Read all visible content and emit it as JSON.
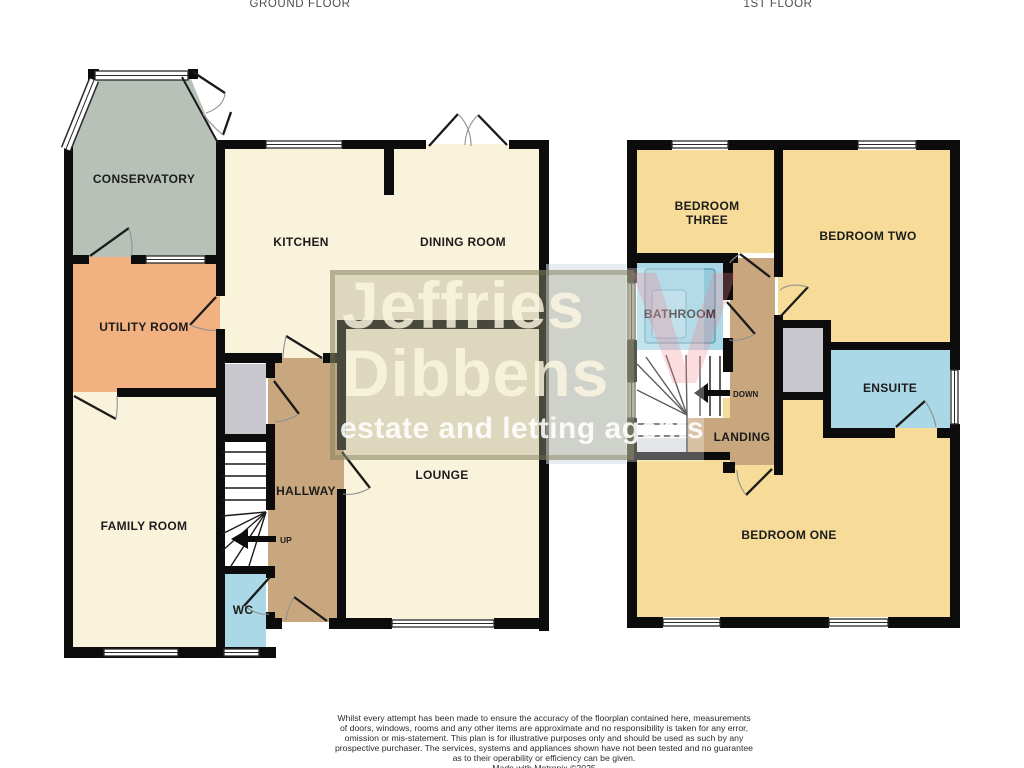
{
  "titles": {
    "ground": "GROUND FLOOR",
    "first": "1ST FLOOR"
  },
  "ground_floor": {
    "conservatory": "CONSERVATORY",
    "utility_room": "UTILITY ROOM",
    "family_room": "FAMILY ROOM",
    "kitchen": "KITCHEN",
    "dining_room": "DINING ROOM",
    "lounge": "LOUNGE",
    "hallway": "HALLWAY",
    "wc": "WC",
    "stairs_direction": "UP"
  },
  "first_floor": {
    "bedroom_three_line1": "BEDROOM",
    "bedroom_three_line2": "THREE",
    "bedroom_two": "BEDROOM TWO",
    "bathroom": "BATHROOM",
    "ensuite": "ENSUITE",
    "landing": "LANDING",
    "bedroom_one": "BEDROOM ONE",
    "stairs_direction": "DOWN"
  },
  "watermark": {
    "name_line1": "Jeffries",
    "name_line2": "Dibbens",
    "tagline": "estate and letting agents"
  },
  "disclaimer": {
    "lines": [
      "Whilst every attempt has been made to ensure the accuracy of the floorplan contained here, measurements",
      "of doors, windows, rooms and any other items are approximate and no responsibility is taken for any error,",
      "omission or mis-statement. This plan is for illustrative purposes only and should be used as such by any",
      "prospective purchaser. The services, systems and appliances shown have not been tested and no guarantee",
      "as to their operability or efficiency can be given.",
      "Made with Metropix ©2025"
    ]
  },
  "colors": {
    "wall": "#0c0c0c",
    "cream_room": "#faf3dc",
    "yellow_room": "#f6dc98",
    "blue_room": "#aad8e6",
    "tan_hall": "#c9a77e",
    "orange_room": "#f1b181",
    "sage_room": "#b7c1b8",
    "gray_cupboard": "#c7c7cd"
  }
}
